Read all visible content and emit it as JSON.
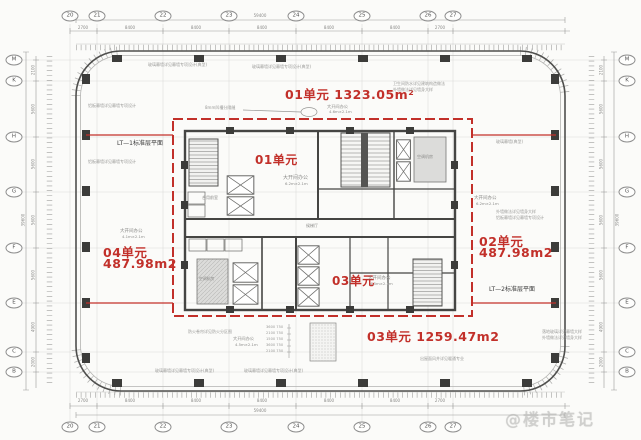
{
  "units": {
    "top_label": "01单元 1323.05m²",
    "right_name": "02单元",
    "right_area": "487.98m2",
    "left_name": "04单元",
    "left_area": "487.98m2",
    "bottom_label": "03单元 1259.47m2",
    "inner_top": "01单元",
    "inner_bottom": "03单元"
  },
  "leaders": {
    "lt1": "LT—1标准层平面",
    "lt2": "LT—2标准层平面"
  },
  "grid": {
    "cols": [
      "20",
      "21",
      "22",
      "23",
      "24",
      "25",
      "26",
      "27"
    ],
    "rows": [
      "M",
      "K",
      "H",
      "G",
      "F",
      "E",
      "C",
      "B"
    ]
  },
  "dims": {
    "top": [
      "2700",
      "8400",
      "8400",
      "8400",
      "8400",
      "8400",
      "2700"
    ],
    "side": [
      "2100",
      "5600",
      "5600",
      "5600",
      "5600",
      "4900",
      "2000"
    ],
    "total_h": "59400",
    "total_v": "39600",
    "stack": [
      "3600 750",
      "2100 750",
      "1500 750",
      "3600 750",
      "2100 750"
    ]
  },
  "rooms": {
    "open_office": "大开间办公",
    "dim_a": "6.2m×2.1m",
    "dim_b": "4.1m×2.1m",
    "dim_c": "4.5m×2.1m",
    "dim_d": "4.6m×2.1m",
    "front_room": "合用前室",
    "lift_lobby": "候梯厅",
    "ac_room": "空调机房"
  },
  "annotations": {
    "curtain": "玻璃幕墙详见幕墙专项设计(典型)",
    "curtain_short": "玻璃幕墙(典型)",
    "alum": "铝板幕墙详见幕墙专项设计",
    "waterproof": "卫生间防水详见建筑构造做法",
    "groove": "8mm凹槽分隔缝",
    "glass": "落地玻璃详见幕墙大样",
    "vent": "出屋面风井详见暖通专业",
    "fire": "防火卷帘详见防火分区图",
    "wall_note": "外墙做法详见墙身大样"
  },
  "watermark": "@楼市笔记",
  "colors": {
    "red": "#c2302a",
    "wall": "#454545",
    "grid": "#d8d8d4",
    "annotation": "#9a9a98"
  }
}
